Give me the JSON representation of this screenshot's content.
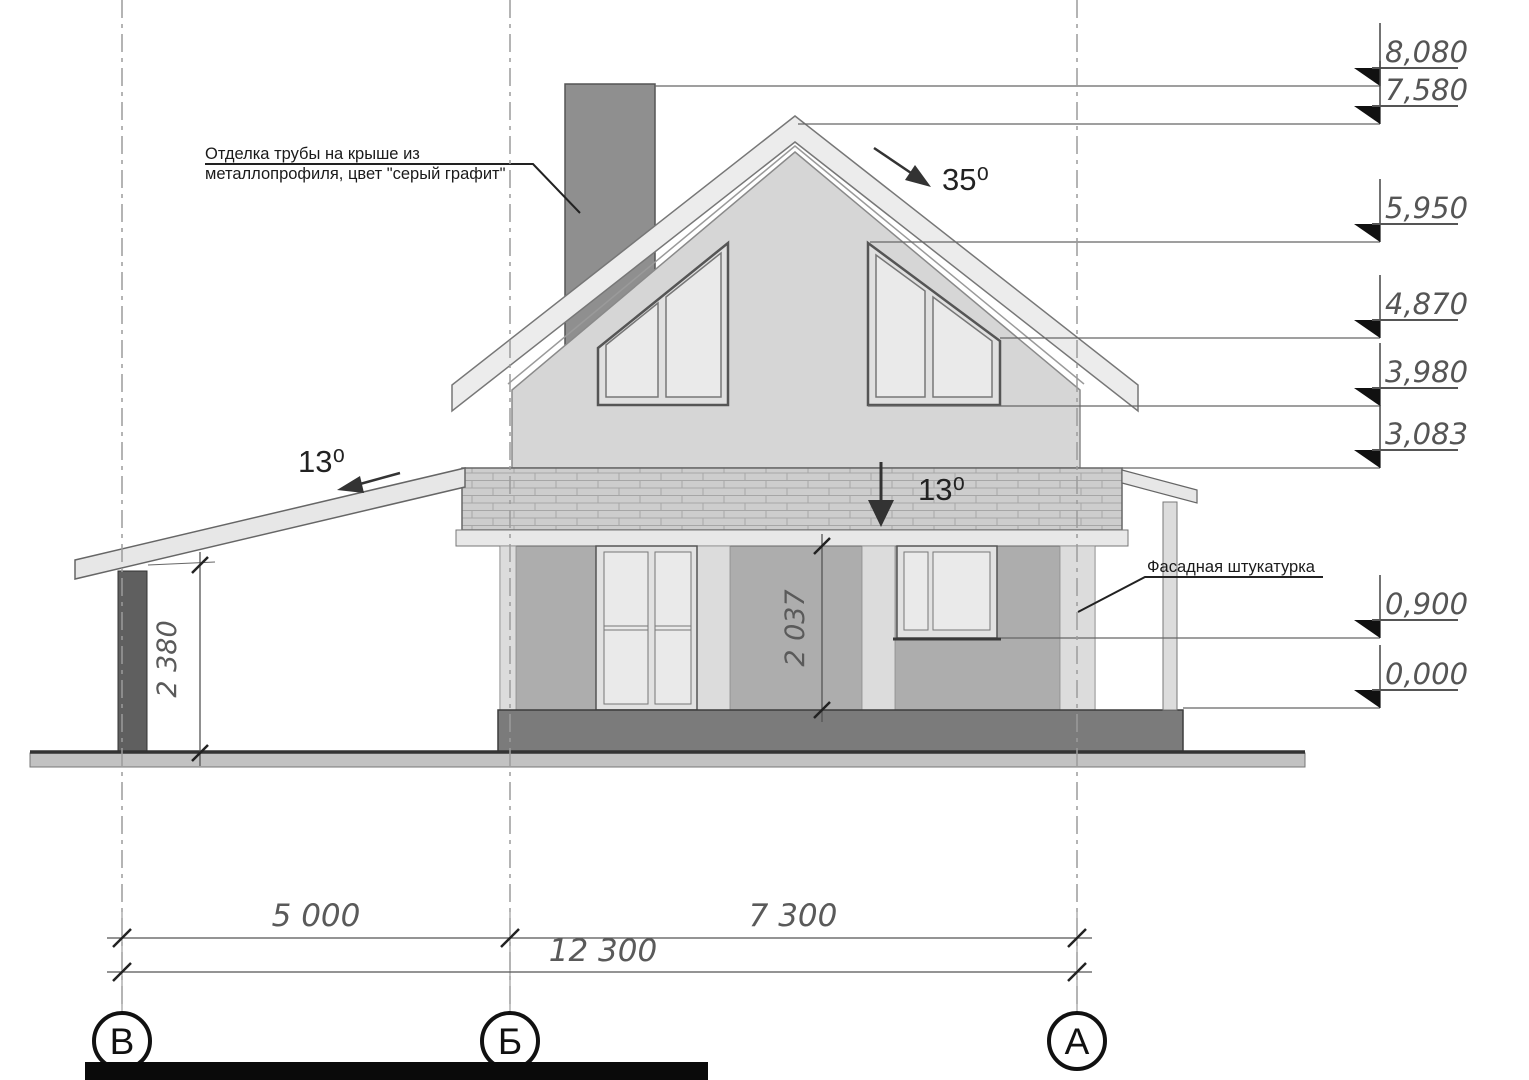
{
  "annotations": {
    "chimney_note_line1": "Отделка трубы на крыше из",
    "chimney_note_line2": "металлопрофиля, цвет \"серый графит\"",
    "facade_note": "Фасадная штукатурка",
    "roof_slope": "35⁰",
    "carport_slope": "13⁰",
    "balcony_slope": "13⁰"
  },
  "elevation_marks": [
    "8,080",
    "7,580",
    "5,950",
    "4,870",
    "3,980",
    "3,083",
    "0,900",
    "0,000"
  ],
  "dimensions": {
    "span_vb": "5 000",
    "span_ba": "7 300",
    "total": "12 300",
    "carport_height": "2 380",
    "opening_height": "2 037"
  },
  "axes": [
    "В",
    "Б",
    "А"
  ],
  "colors": {
    "chimney": "#8f8f8f",
    "gable_wall": "#d6d6d6",
    "roof_band": "#ececec",
    "balcony_band": "#cdcdcd",
    "lower_wall": "#adadad",
    "pilaster": "#dcdcdc",
    "glass": "#eaeaea",
    "plinth": "#7b7b7b",
    "ground": "#c2c2c2",
    "carport_post": "#5f5f5f",
    "line": "#444444"
  }
}
